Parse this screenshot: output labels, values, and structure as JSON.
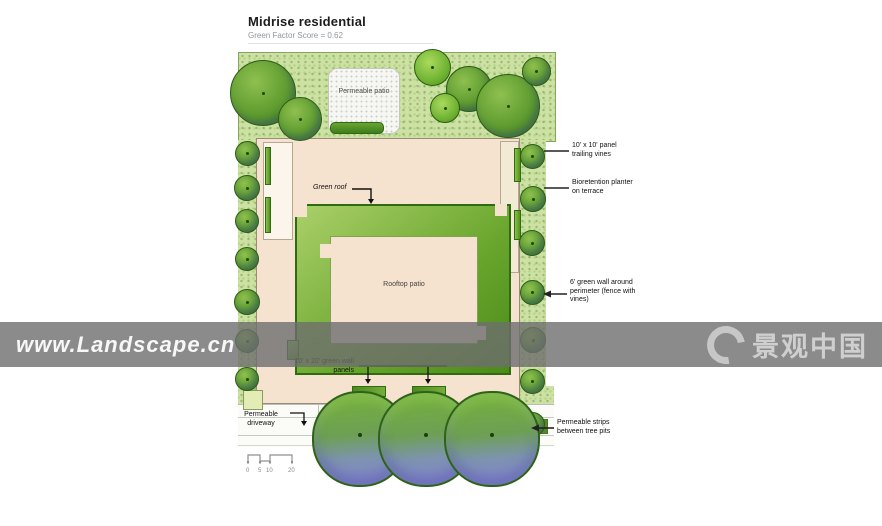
{
  "header": {
    "title": "Midrise residential",
    "subtitle": "Green Factor Score = 0.62"
  },
  "plan_labels": {
    "permeable_patio": "Permeable patio",
    "green_roof": "Green roof",
    "rooftop_patio": "Rooftop patio",
    "green_wall_panels": "10' x 20' green wall panels",
    "permeable_driveway": "Permeable driveway"
  },
  "callouts": [
    {
      "id": "trailing-vines",
      "text": "10' x 10' panel trailing vines"
    },
    {
      "id": "bioretention-planter",
      "text": "Bioretention planter on terrace"
    },
    {
      "id": "perimeter-green-wall",
      "text": "6' green wall around perimeter (fence with vines)"
    },
    {
      "id": "permeable-strips",
      "text": "Permeable strips between tree pits"
    }
  ],
  "scale_bar": {
    "ticks": [
      "0",
      "5",
      "10",
      "20"
    ]
  },
  "watermarks": {
    "left": "www.Landscape.cn",
    "right": "景观中国"
  },
  "colors": {
    "building": "#f5e2cf",
    "green_roof_light": "#abd06a",
    "green_roof_dark": "#4c8a1a",
    "garden": "#cde1a4",
    "tree_green": "#5f9c30",
    "street_tree_blue": "#868bc8",
    "watermark_gray": "#6e6e6e"
  }
}
